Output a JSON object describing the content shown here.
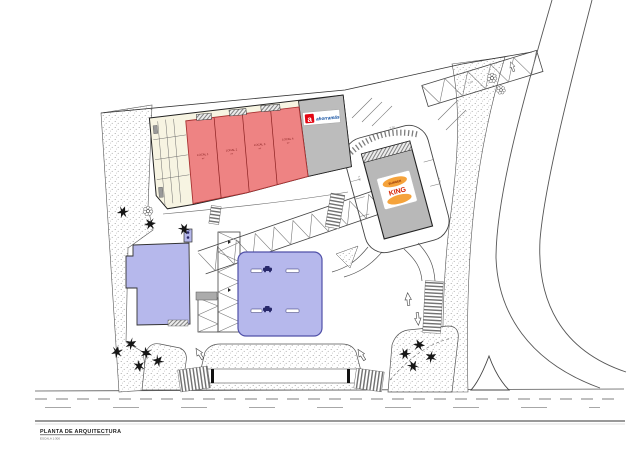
{
  "title_block": {
    "title": "PLANTA DE ARQUITECTURA",
    "scale": "ESCALA 1:300"
  },
  "main_building": {
    "anchor": {
      "brand": "ahorramás",
      "logo_letter": "a"
    },
    "locals": [
      {
        "label": "LOCAL 1",
        "area": "m²"
      },
      {
        "label": "LOCAL 2",
        "area": "m²"
      },
      {
        "label": "LOCAL 3",
        "area": "m²"
      },
      {
        "label": "LOCAL 4",
        "area": "m²"
      }
    ]
  },
  "burger_king": {
    "line1": "BURGER",
    "line2": "KING"
  },
  "dimension_labels": [
    "6.00",
    "6.00",
    "5.50",
    "5.00"
  ],
  "colors": {
    "local_red": "#ee8383",
    "local_red_stroke": "#a83232",
    "building_cream": "#f7f4e2",
    "gray_unit": "#bcbcbc",
    "lavender": "#b6b8ec",
    "lavender_stroke": "#4c4c9a",
    "bk_gray": "#b8b8b8",
    "bk_bun_orange": "#f5a33b",
    "bk_red": "#d62300",
    "ahorramas_red": "#e30613",
    "ahorramas_blue": "#0a4a9e",
    "line_dark": "#444444"
  }
}
